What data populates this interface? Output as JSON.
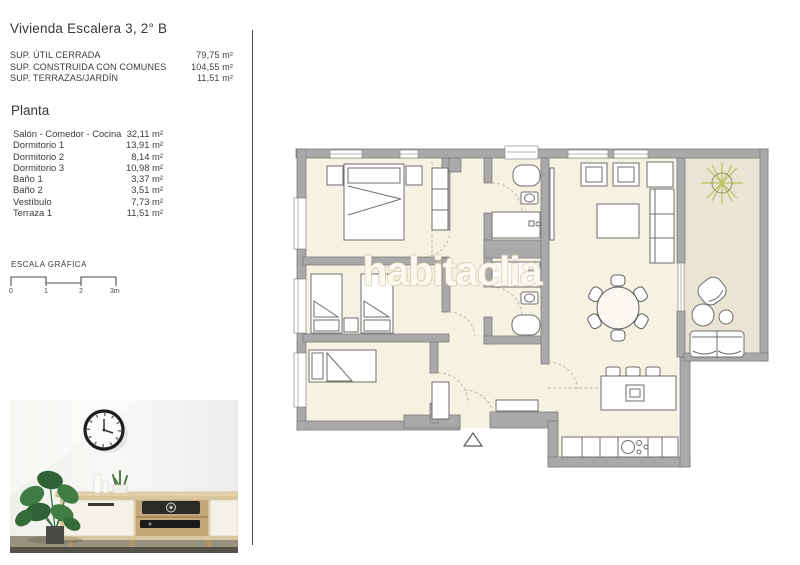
{
  "header": {
    "title": "Vivienda Escalera 3, 2° B"
  },
  "summary": [
    {
      "label": "SUP. ÚTIL CERRADA",
      "value": "79,75 m²"
    },
    {
      "label": "SUP. CONSTRUIDA CON COMUNES",
      "value": "104,55 m²"
    },
    {
      "label": "SUP. TERRAZAS/JARDÍN",
      "value": "11,51 m²"
    }
  ],
  "planta": {
    "heading": "Planta",
    "rooms": [
      {
        "name": "Salón - Comedor - Cocina",
        "area": "32,11 m²"
      },
      {
        "name": "Dormitorio 1",
        "area": "13,91 m²"
      },
      {
        "name": "Dormitorio 2",
        "area": "8,14 m²"
      },
      {
        "name": "Dormitorio 3",
        "area": "10,98 m²"
      },
      {
        "name": "Baño 1",
        "area": "3,37 m²"
      },
      {
        "name": "Baño 2",
        "area": "3,51 m²"
      },
      {
        "name": "Vestíbulo",
        "area": "7,73 m²"
      },
      {
        "name": "Terraza 1",
        "area": "11,51 m²"
      }
    ]
  },
  "scale": {
    "heading": "ESCALA GRÁFICA",
    "ticks": [
      "0",
      "1",
      "2",
      "3m"
    ]
  },
  "watermark": "habitaclia",
  "colors": {
    "wall": "#a9a9a9",
    "floor": "#f5f2e3",
    "terrace": "#e9e4d3",
    "furniture_line": "#6e6e6e",
    "door_dash": "#c0b89b",
    "plant": "#b9c45f",
    "text": "#3b3b3b"
  }
}
